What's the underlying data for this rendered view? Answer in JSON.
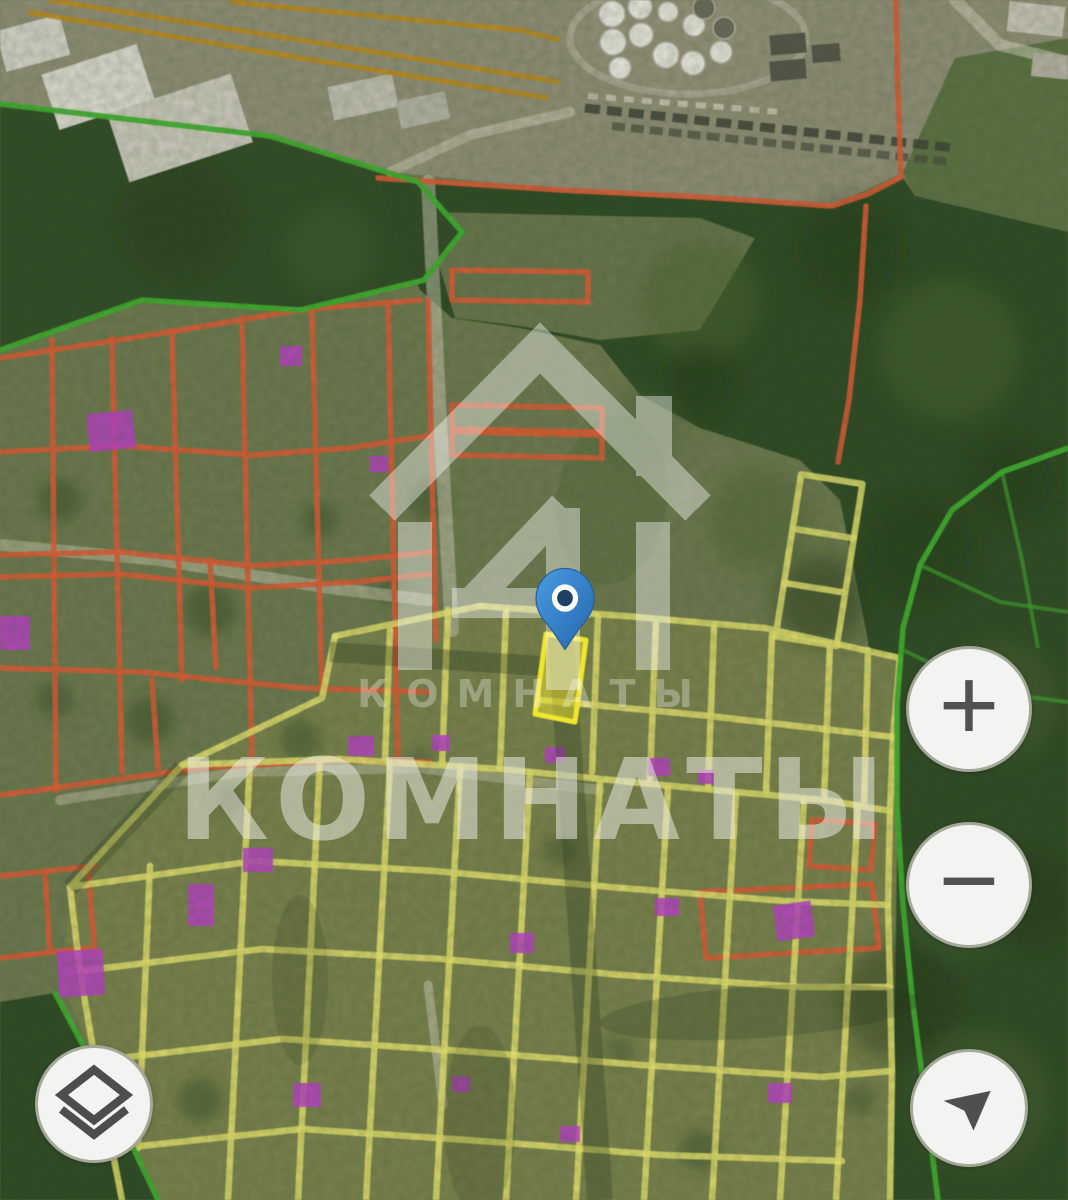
{
  "watermark": {
    "brand_text_small": "КОМНАТЫ",
    "brand_text_large": "КОМНАТЫ",
    "logo": "house-4-logo"
  },
  "controls": {
    "zoom_in_label": "+",
    "zoom_out_label": "−"
  },
  "map": {
    "view": "satellite",
    "marker": "selected-parcel-pin"
  },
  "palette": {
    "cadastral_red": "#dd5a36",
    "cadastral_yellow": "#e8e370",
    "selected_yellow": "#f0e62e",
    "forest_border_green": "#3fae2e",
    "industrial_ochre": "#bd8a1e",
    "building_magenta": "#bb3ec9",
    "pin_blue": "#4a9ae2",
    "pin_blue_dark": "#2468ae",
    "forest_dark": "#2f4826",
    "village_olive": "#6e7850",
    "garden_olive": "#7a814e",
    "industrial_gray": "#908d78",
    "button_bg": "#f3f3f1",
    "button_rim": "#a3a899",
    "icon_gray": "#515151"
  }
}
